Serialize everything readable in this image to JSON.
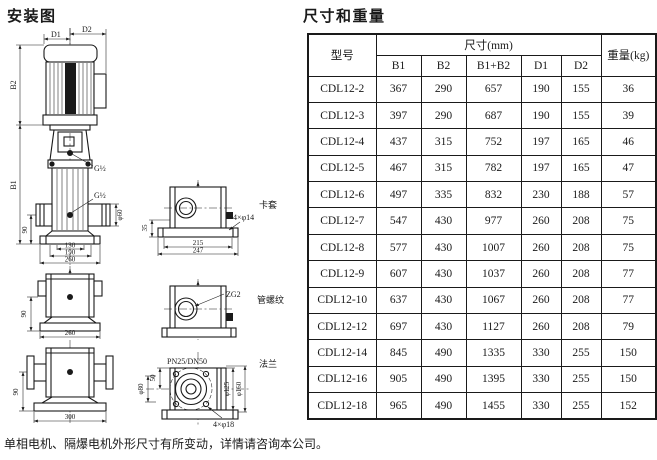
{
  "page": {
    "diagram_title": "安装图",
    "table_title": "尺寸和重量",
    "footnote": "单相电机、隔爆电机外形尺寸有所变动，详情请咨询本公司。"
  },
  "table": {
    "col_model": "型号",
    "col_dims_group": "尺寸(mm)",
    "col_b1": "B1",
    "col_b2": "B2",
    "col_b1b2": "B1+B2",
    "col_d1": "D1",
    "col_d2": "D2",
    "col_weight": "重量(kg)",
    "rows": [
      [
        "CDL12-2",
        "367",
        "290",
        "657",
        "190",
        "155",
        "36"
      ],
      [
        "CDL12-3",
        "397",
        "290",
        "687",
        "190",
        "155",
        "39"
      ],
      [
        "CDL12-4",
        "437",
        "315",
        "752",
        "197",
        "165",
        "46"
      ],
      [
        "CDL12-5",
        "467",
        "315",
        "782",
        "197",
        "165",
        "47"
      ],
      [
        "CDL12-6",
        "497",
        "335",
        "832",
        "230",
        "188",
        "57"
      ],
      [
        "CDL12-7",
        "547",
        "430",
        "977",
        "260",
        "208",
        "75"
      ],
      [
        "CDL12-8",
        "577",
        "430",
        "1007",
        "260",
        "208",
        "75"
      ],
      [
        "CDL12-9",
        "607",
        "430",
        "1037",
        "260",
        "208",
        "77"
      ],
      [
        "CDL12-10",
        "637",
        "430",
        "1067",
        "260",
        "208",
        "77"
      ],
      [
        "CDL12-12",
        "697",
        "430",
        "1127",
        "260",
        "208",
        "79"
      ],
      [
        "CDL12-14",
        "845",
        "490",
        "1335",
        "330",
        "255",
        "150"
      ],
      [
        "CDL12-16",
        "905",
        "490",
        "1395",
        "330",
        "255",
        "150"
      ],
      [
        "CDL12-18",
        "965",
        "490",
        "1455",
        "330",
        "255",
        "152"
      ]
    ]
  },
  "diagram": {
    "main": {
      "dim_d1": "D1",
      "dim_d2": "D2",
      "dim_b2": "B2",
      "dim_b1": "B1",
      "thread_1": "G½",
      "thread_2": "G½",
      "dim_130": "130",
      "dim_190": "190",
      "dim_260": "260",
      "dim_90": "90",
      "dim_phi60": "φ60"
    },
    "clamp_view": {
      "name": "卡套",
      "dim_35": "35",
      "dim_215": "215",
      "dim_247": "247",
      "holes": "4×φ14"
    },
    "thread_view": {
      "name": "管螺纹",
      "thread": "ZG2"
    },
    "flange_view": {
      "name": "法兰",
      "spec": "PN25/DN50",
      "dim_50": "50",
      "dim_phi80": "φ80",
      "dim_phi125": "φ125",
      "dim_phi160": "φ160",
      "holes": "4×φ18"
    },
    "base_view_1": {
      "dim_90": "90",
      "dim_260": "260"
    },
    "base_view_2": {
      "dim_90": "90",
      "dim_300": "300"
    }
  }
}
